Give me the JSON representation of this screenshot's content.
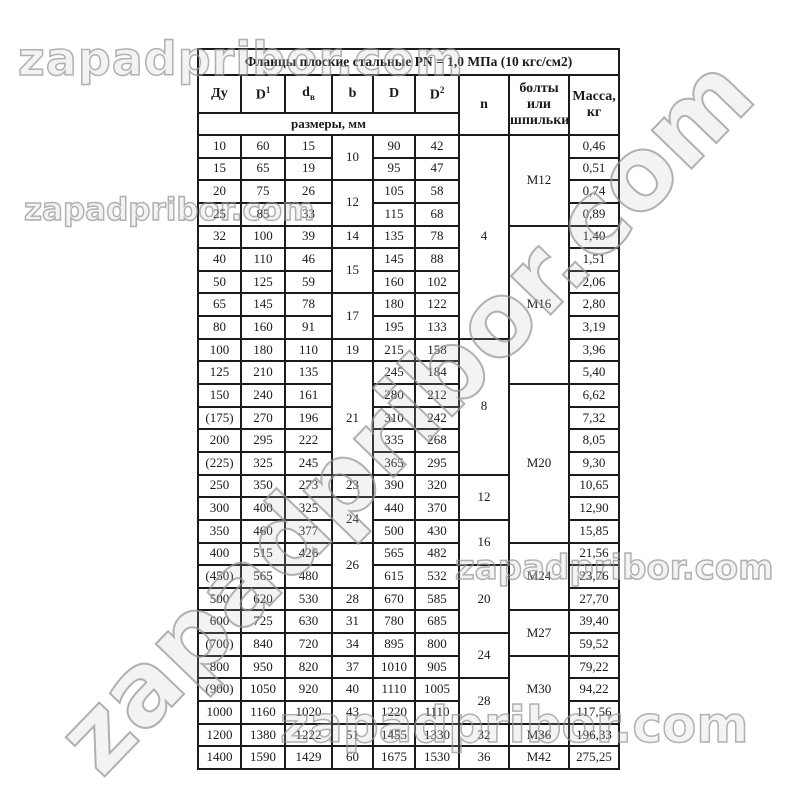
{
  "watermark": {
    "text": "zapadpribor.com"
  },
  "table": {
    "title": "Фланцы плоские стальные PN = 1,0 МПа (10 кгс/см2)",
    "headers": {
      "du": "Ду",
      "d1_base": "D",
      "d1_sup": "1",
      "dv_base": "d",
      "dv_sub": "в",
      "b": "b",
      "d": "D",
      "d2_base": "D",
      "d2_sup": "2",
      "n": "n",
      "bolts": "болты или шпильки",
      "mass": "Масса, кг",
      "sizes": "размеры, мм"
    },
    "rows": [
      [
        "10",
        "60",
        "15",
        {
          "t": "10",
          "rs": 2
        },
        "90",
        "42",
        {
          "t": "4",
          "rs": 9
        },
        {
          "t": "М12",
          "rs": 4
        },
        "0,46"
      ],
      [
        "15",
        "65",
        "19",
        null,
        "95",
        "47",
        null,
        null,
        "0,51"
      ],
      [
        "20",
        "75",
        "26",
        {
          "t": "12",
          "rs": 2
        },
        "105",
        "58",
        null,
        null,
        "0,74"
      ],
      [
        "25",
        "85",
        "33",
        null,
        "115",
        "68",
        null,
        null,
        "0,89"
      ],
      [
        "32",
        "100",
        "39",
        "14",
        "135",
        "78",
        null,
        {
          "t": "М16",
          "rs": 7
        },
        "1,40"
      ],
      [
        "40",
        "110",
        "46",
        {
          "t": "15",
          "rs": 2
        },
        "145",
        "88",
        null,
        null,
        "1,51"
      ],
      [
        "50",
        "125",
        "59",
        null,
        "160",
        "102",
        null,
        null,
        "2,06"
      ],
      [
        "65",
        "145",
        "78",
        {
          "t": "17",
          "rs": 2
        },
        "180",
        "122",
        null,
        null,
        "2,80"
      ],
      [
        "80",
        "160",
        "91",
        null,
        "195",
        "133",
        null,
        null,
        "3,19"
      ],
      [
        "100",
        "180",
        "110",
        "19",
        "215",
        "158",
        {
          "t": "8",
          "rs": 6
        },
        null,
        "3,96"
      ],
      [
        "125",
        "210",
        "135",
        {
          "t": "21",
          "rs": 5
        },
        "245",
        "184",
        null,
        null,
        "5,40"
      ],
      [
        "150",
        "240",
        "161",
        null,
        "280",
        "212",
        null,
        {
          "t": "М20",
          "rs": 7
        },
        "6,62"
      ],
      [
        "(175)",
        "270",
        "196",
        null,
        "310",
        "242",
        null,
        null,
        "7,32"
      ],
      [
        "200",
        "295",
        "222",
        null,
        "335",
        "268",
        null,
        null,
        "8,05"
      ],
      [
        "(225)",
        "325",
        "245",
        null,
        "365",
        "295",
        null,
        null,
        "9,30"
      ],
      [
        "250",
        "350",
        "273",
        "23",
        "390",
        "320",
        {
          "t": "12",
          "rs": 2
        },
        null,
        "10,65"
      ],
      [
        "300",
        "400",
        "325",
        {
          "t": "24",
          "rs": 2
        },
        "440",
        "370",
        null,
        null,
        "12,90"
      ],
      [
        "350",
        "460",
        "377",
        null,
        "500",
        "430",
        {
          "t": "16",
          "rs": 2
        },
        null,
        "15,85"
      ],
      [
        "400",
        "515",
        "426",
        {
          "t": "26",
          "rs": 2
        },
        "565",
        "482",
        null,
        {
          "t": "М24",
          "rs": 3
        },
        "21,56"
      ],
      [
        "(450)",
        "565",
        "480",
        null,
        "615",
        "532",
        {
          "t": "20",
          "rs": 3
        },
        null,
        "23,76"
      ],
      [
        "500",
        "620",
        "530",
        "28",
        "670",
        "585",
        null,
        null,
        "27,70"
      ],
      [
        "600",
        "725",
        "630",
        "31",
        "780",
        "685",
        null,
        {
          "t": "М27",
          "rs": 2
        },
        "39,40"
      ],
      [
        "(700)",
        "840",
        "720",
        "34",
        "895",
        "800",
        {
          "t": "24",
          "rs": 2
        },
        null,
        "59,52"
      ],
      [
        "800",
        "950",
        "820",
        "37",
        "1010",
        "905",
        null,
        {
          "t": "М30",
          "rs": 3
        },
        "79,22"
      ],
      [
        "(900)",
        "1050",
        "920",
        "40",
        "1110",
        "1005",
        {
          "t": "28",
          "rs": 2
        },
        null,
        "94,22"
      ],
      [
        "1000",
        "1160",
        "1020",
        "43",
        "1220",
        "1110",
        null,
        null,
        "117,56"
      ],
      [
        "1200",
        "1380",
        "1222",
        "51",
        "1455",
        "1330",
        "32",
        "М36",
        "196,33"
      ],
      [
        "1400",
        "1590",
        "1429",
        "60",
        "1675",
        "1530",
        "36",
        "М42",
        "275,25"
      ]
    ]
  }
}
